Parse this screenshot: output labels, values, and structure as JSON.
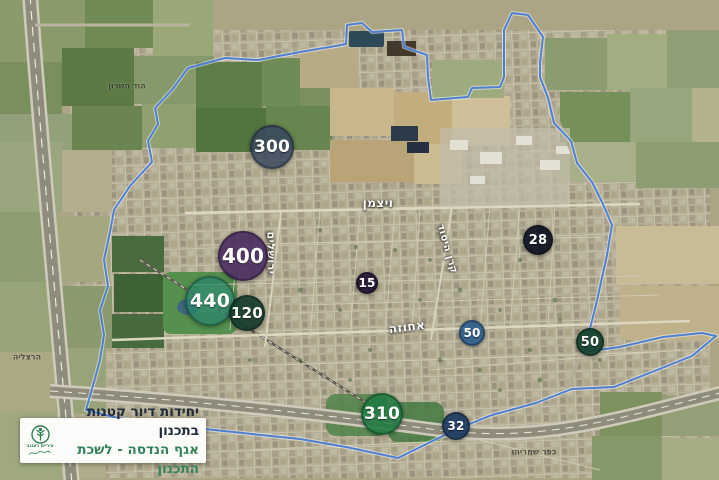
{
  "legend": {
    "title": "יחידות דיור קטנות בתכנון",
    "subtitle": "אגף הנדסה - לשכת התכנון",
    "title_color": "#222b3a",
    "subtitle_color": "#35835a",
    "logo": {
      "caption": "עיריית רעננה",
      "color": "#2e7d4f"
    }
  },
  "boundary": {
    "color": "#4f7fd0",
    "glow": "#ffffff",
    "points": "188,68 225,58 258,60 300,52 330,47 346,44 347,25 362,23 372,32 402,30 404,47 427,55 428,77 431,100 468,97 472,88 500,87 504,77 504,30 512,13 528,15 543,37 540,63 540,77 548,98 554,123 571,141 577,163 592,182 602,202 612,225 607,255 596,305 584,352 620,347 663,337 702,333 716,336 692,356 652,372 614,387 572,389 536,403 492,415 457,429 398,458 346,447 300,439 252,434 205,429 160,424 118,418 86,410 94,382 100,360 104,335 100,310 108,286 104,260 110,232 114,210 130,186 152,162 148,141 158,124 155,108 172,90"
  },
  "markers": [
    {
      "value": "300",
      "x": 272,
      "y": 147,
      "r": 22,
      "color": "rgba(54,68,94,0.82)",
      "font": 17
    },
    {
      "value": "400",
      "x": 243,
      "y": 256,
      "r": 25,
      "color": "rgba(67,37,94,0.86)",
      "font": 20
    },
    {
      "value": "440",
      "x": 210,
      "y": 301,
      "r": 25,
      "color": "rgba(39,131,107,0.72)",
      "font": 19
    },
    {
      "value": "120",
      "x": 247,
      "y": 313,
      "r": 18,
      "color": "rgba(18,57,42,0.9)",
      "font": 15
    },
    {
      "value": "15",
      "x": 367,
      "y": 283,
      "r": 11,
      "color": "rgba(34,18,51,0.93)",
      "font": 12
    },
    {
      "value": "28",
      "x": 538,
      "y": 240,
      "r": 15,
      "color": "rgba(14,19,34,0.93)",
      "font": 13
    },
    {
      "value": "50",
      "x": 472,
      "y": 333,
      "r": 13,
      "color": "rgba(38,89,139,0.88)",
      "font": 12
    },
    {
      "value": "50",
      "x": 590,
      "y": 342,
      "r": 14,
      "color": "rgba(18,63,45,0.92)",
      "font": 13
    },
    {
      "value": "310",
      "x": 382,
      "y": 414,
      "r": 21,
      "color": "rgba(31,122,66,0.88)",
      "font": 17
    },
    {
      "value": "32",
      "x": 456,
      "y": 426,
      "r": 14,
      "color": "rgba(28,58,94,0.92)",
      "font": 12
    }
  ],
  "street_labels": [
    {
      "text": "ויצמן",
      "x": 378,
      "y": 203,
      "rotate": 0,
      "size": 12
    },
    {
      "text": "ירושלים",
      "x": 271,
      "y": 253,
      "rotate": 90,
      "size": 11
    },
    {
      "text": "קרן היסוד",
      "x": 447,
      "y": 249,
      "rotate": 74,
      "size": 10
    },
    {
      "text": "אחוזה",
      "x": 407,
      "y": 327,
      "rotate": -7,
      "size": 12
    }
  ],
  "place_labels": [
    {
      "text": "הוד השרון",
      "x": 127,
      "y": 86
    },
    {
      "text": "הרצליה",
      "x": 27,
      "y": 357
    },
    {
      "text": "כפר שמריהו",
      "x": 534,
      "y": 452
    }
  ]
}
